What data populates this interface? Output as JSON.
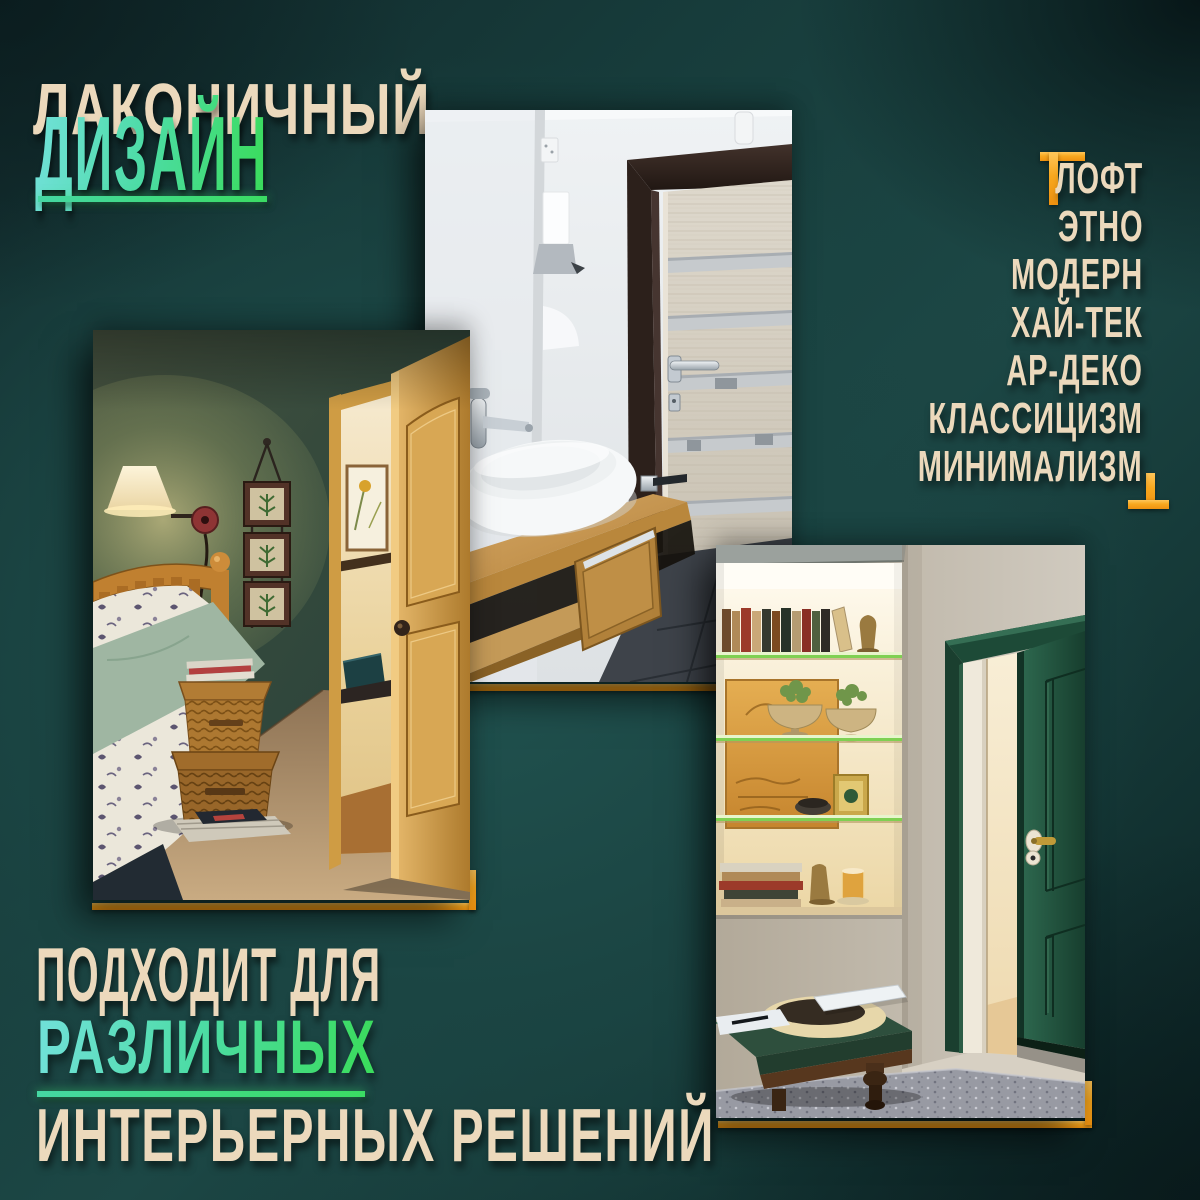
{
  "title": {
    "line1": "ЛАКОНИЧНЫЙ",
    "line2": "ДИЗАЙН"
  },
  "styles_list": {
    "items": [
      "ЛОФТ",
      "ЭТНО",
      "МОДЕРН",
      "ХАЙ-ТЕК",
      "АР-ДЕКО",
      "КЛАССИЦИЗМ",
      "МИНИМАЛИЗМ"
    ]
  },
  "footer": {
    "line1": "ПОДХОДИТ ДЛЯ",
    "line2": "РАЗЛИЧНЫХ",
    "line3": "ИНТЕРЬЕРНЫХ РЕШЕНИЙ"
  },
  "photos": {
    "bedroom": {
      "alt": "Спальня с тёмно-зелёными стенами и открытой светлой деревянной дверью"
    },
    "bathroom": {
      "alt": "Ванная с раковиной на деревянной столешнице и светлой дверью в тёмной коробке"
    },
    "living_room": {
      "alt": "Комната с подсвеченной нишей-витриной и открытой тёмно-зелёной дверью"
    }
  },
  "colors": {
    "background": "#1c4745",
    "background_dark": "#0c2324",
    "text_cream": "#ecd9bc",
    "gradient_teal": "#6fe0d6",
    "gradient_green": "#3bdc5e",
    "underline_green": "#3ed96c",
    "accent_orange": "#f8a81f"
  }
}
